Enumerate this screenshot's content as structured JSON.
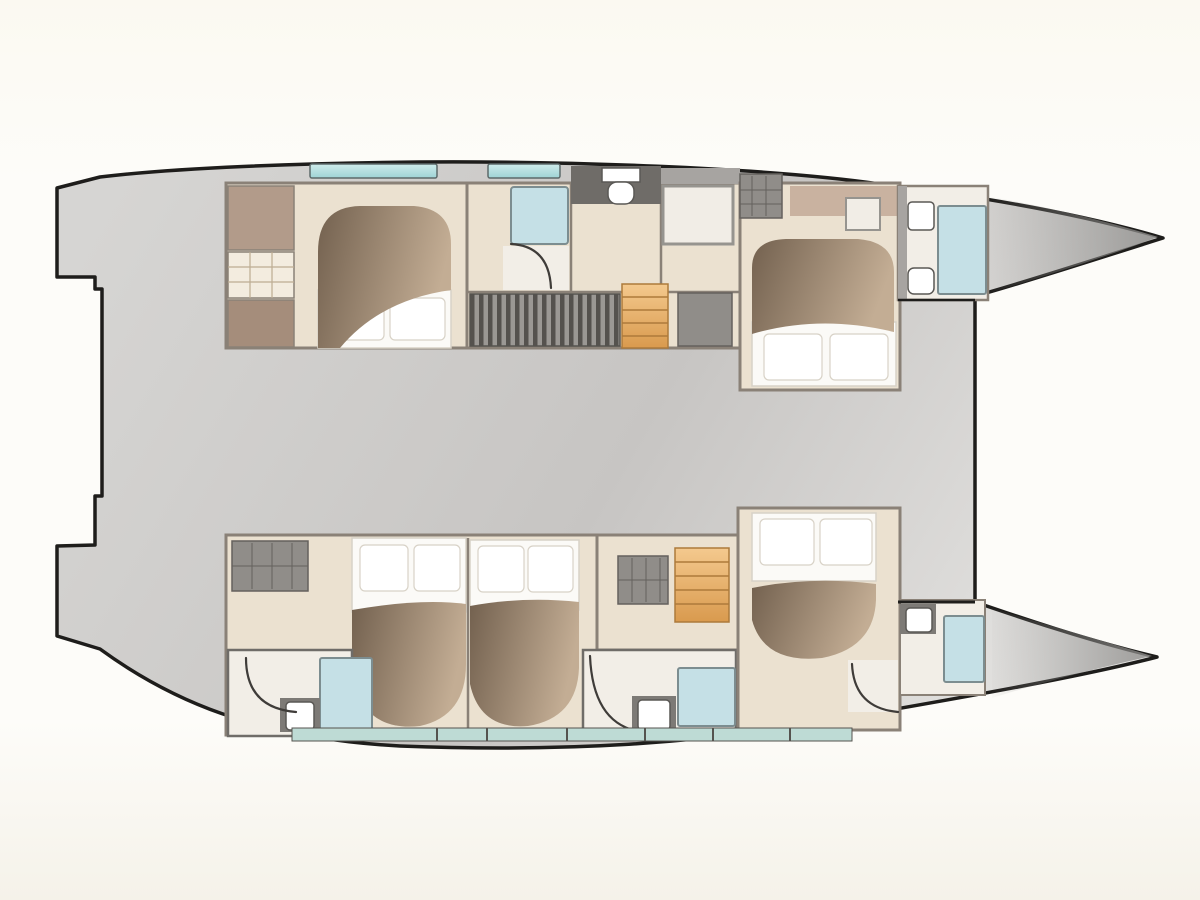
{
  "plan": {
    "vessel": "catamaran",
    "view": "top-down-floor-plan",
    "hulls": [
      {
        "name": "port-hull",
        "rooms": [
          "aft-cabin",
          "aft-shower-room",
          "wc-room",
          "corridor",
          "forward-cabin",
          "forward-bathroom",
          "bow"
        ]
      },
      {
        "name": "starboard-hull",
        "rooms": [
          "aft-bathroom",
          "aft-cabin",
          "mid-cabin",
          "mid-bathroom",
          "corridor",
          "forward-cabin",
          "forward-bathroom",
          "bow"
        ]
      }
    ],
    "fixtures": [
      "double-bed",
      "pillow",
      "duvet",
      "shower",
      "toilet",
      "washbasin",
      "wardrobe",
      "vanity",
      "hatch",
      "stairs",
      "settee",
      "hull-window",
      "window-band",
      "deck",
      "stern-steps",
      "crossbeam",
      "door-swing"
    ]
  },
  "palette": {
    "bg_top": "#fbf9f1",
    "bg_mid": "#fdfcf9",
    "bg_bottom": "#f5f2e9",
    "outline": "#1e1d1b",
    "deck_light": "#d6d5d3",
    "deck_mid": "#c7c5c3",
    "deck_bright": "#e3e2e0",
    "bow_dark": "#8e8d8b",
    "wall": "#8a8177",
    "wall_dark": "#6f6c68",
    "band_gray": "#a7a4a1",
    "floor": "#ebe1d0",
    "floor_light": "#f2eee7",
    "taupe": "#b29b8a",
    "cabinet_brown": "#a58d7b",
    "vanity": "#f3ecdf",
    "vanity_line": "#bdac92",
    "shelf_tan": "#c9b2a0",
    "bed_dark": "#73614f",
    "bed_light": "#c3ad94",
    "mattress": "#fbfaf7",
    "pillow": "#ffffff",
    "pillow_line": "#d8d2c7",
    "window_teal": "#9ed3d5",
    "window_teal_light": "#cfeceb",
    "window_frame": "#5d6a6a",
    "glass": "#c5e0e6",
    "glass_frame": "#7c8d90",
    "band_teal": "#bedbd5",
    "band_line": "#55534f",
    "hatch_gray": "#908d89",
    "hatch_line": "#64615d",
    "hatch_white": "#f1ede6",
    "hatch_frame": "#96948f",
    "slat_dark": "#55524e",
    "slat_light": "#9b9894",
    "stairs_light": "#f4c98e",
    "stairs_dark": "#d99a4e",
    "stairs_line": "#ad7a3b",
    "wc_gray": "#7d7a76",
    "wc_white": "#ffffff",
    "wc_line": "#5a5855",
    "door_arc": "#3f3c39"
  }
}
